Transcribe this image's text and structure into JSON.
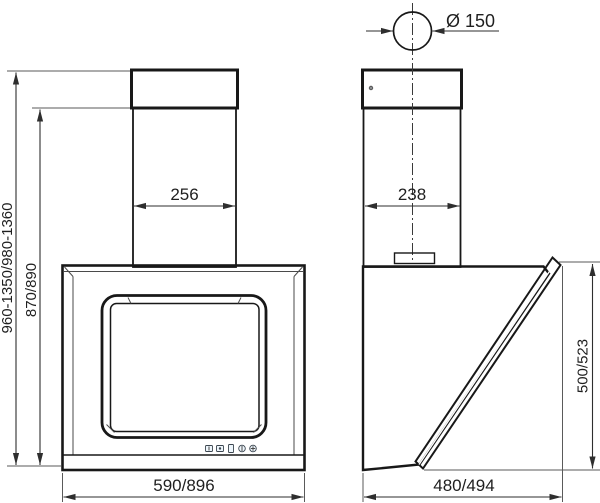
{
  "diagram": {
    "front_view": {
      "chimney_width": "256",
      "hood_width": "590/896",
      "overall_height_range": "960-1350/980-1360",
      "body_height": "870/890"
    },
    "side_view": {
      "duct_diameter": "Ø 150",
      "chimney_depth": "238",
      "hood_depth": "480/494",
      "front_panel_height": "500/523"
    }
  },
  "colors": {
    "outline": "#181818",
    "dimension_line": "#2e2e2e",
    "steel_light": "#f2f3f3",
    "steel_dark": "#a9acad",
    "body_blue": "#c5e1f3",
    "glass_blue": "#c9e5f7"
  }
}
